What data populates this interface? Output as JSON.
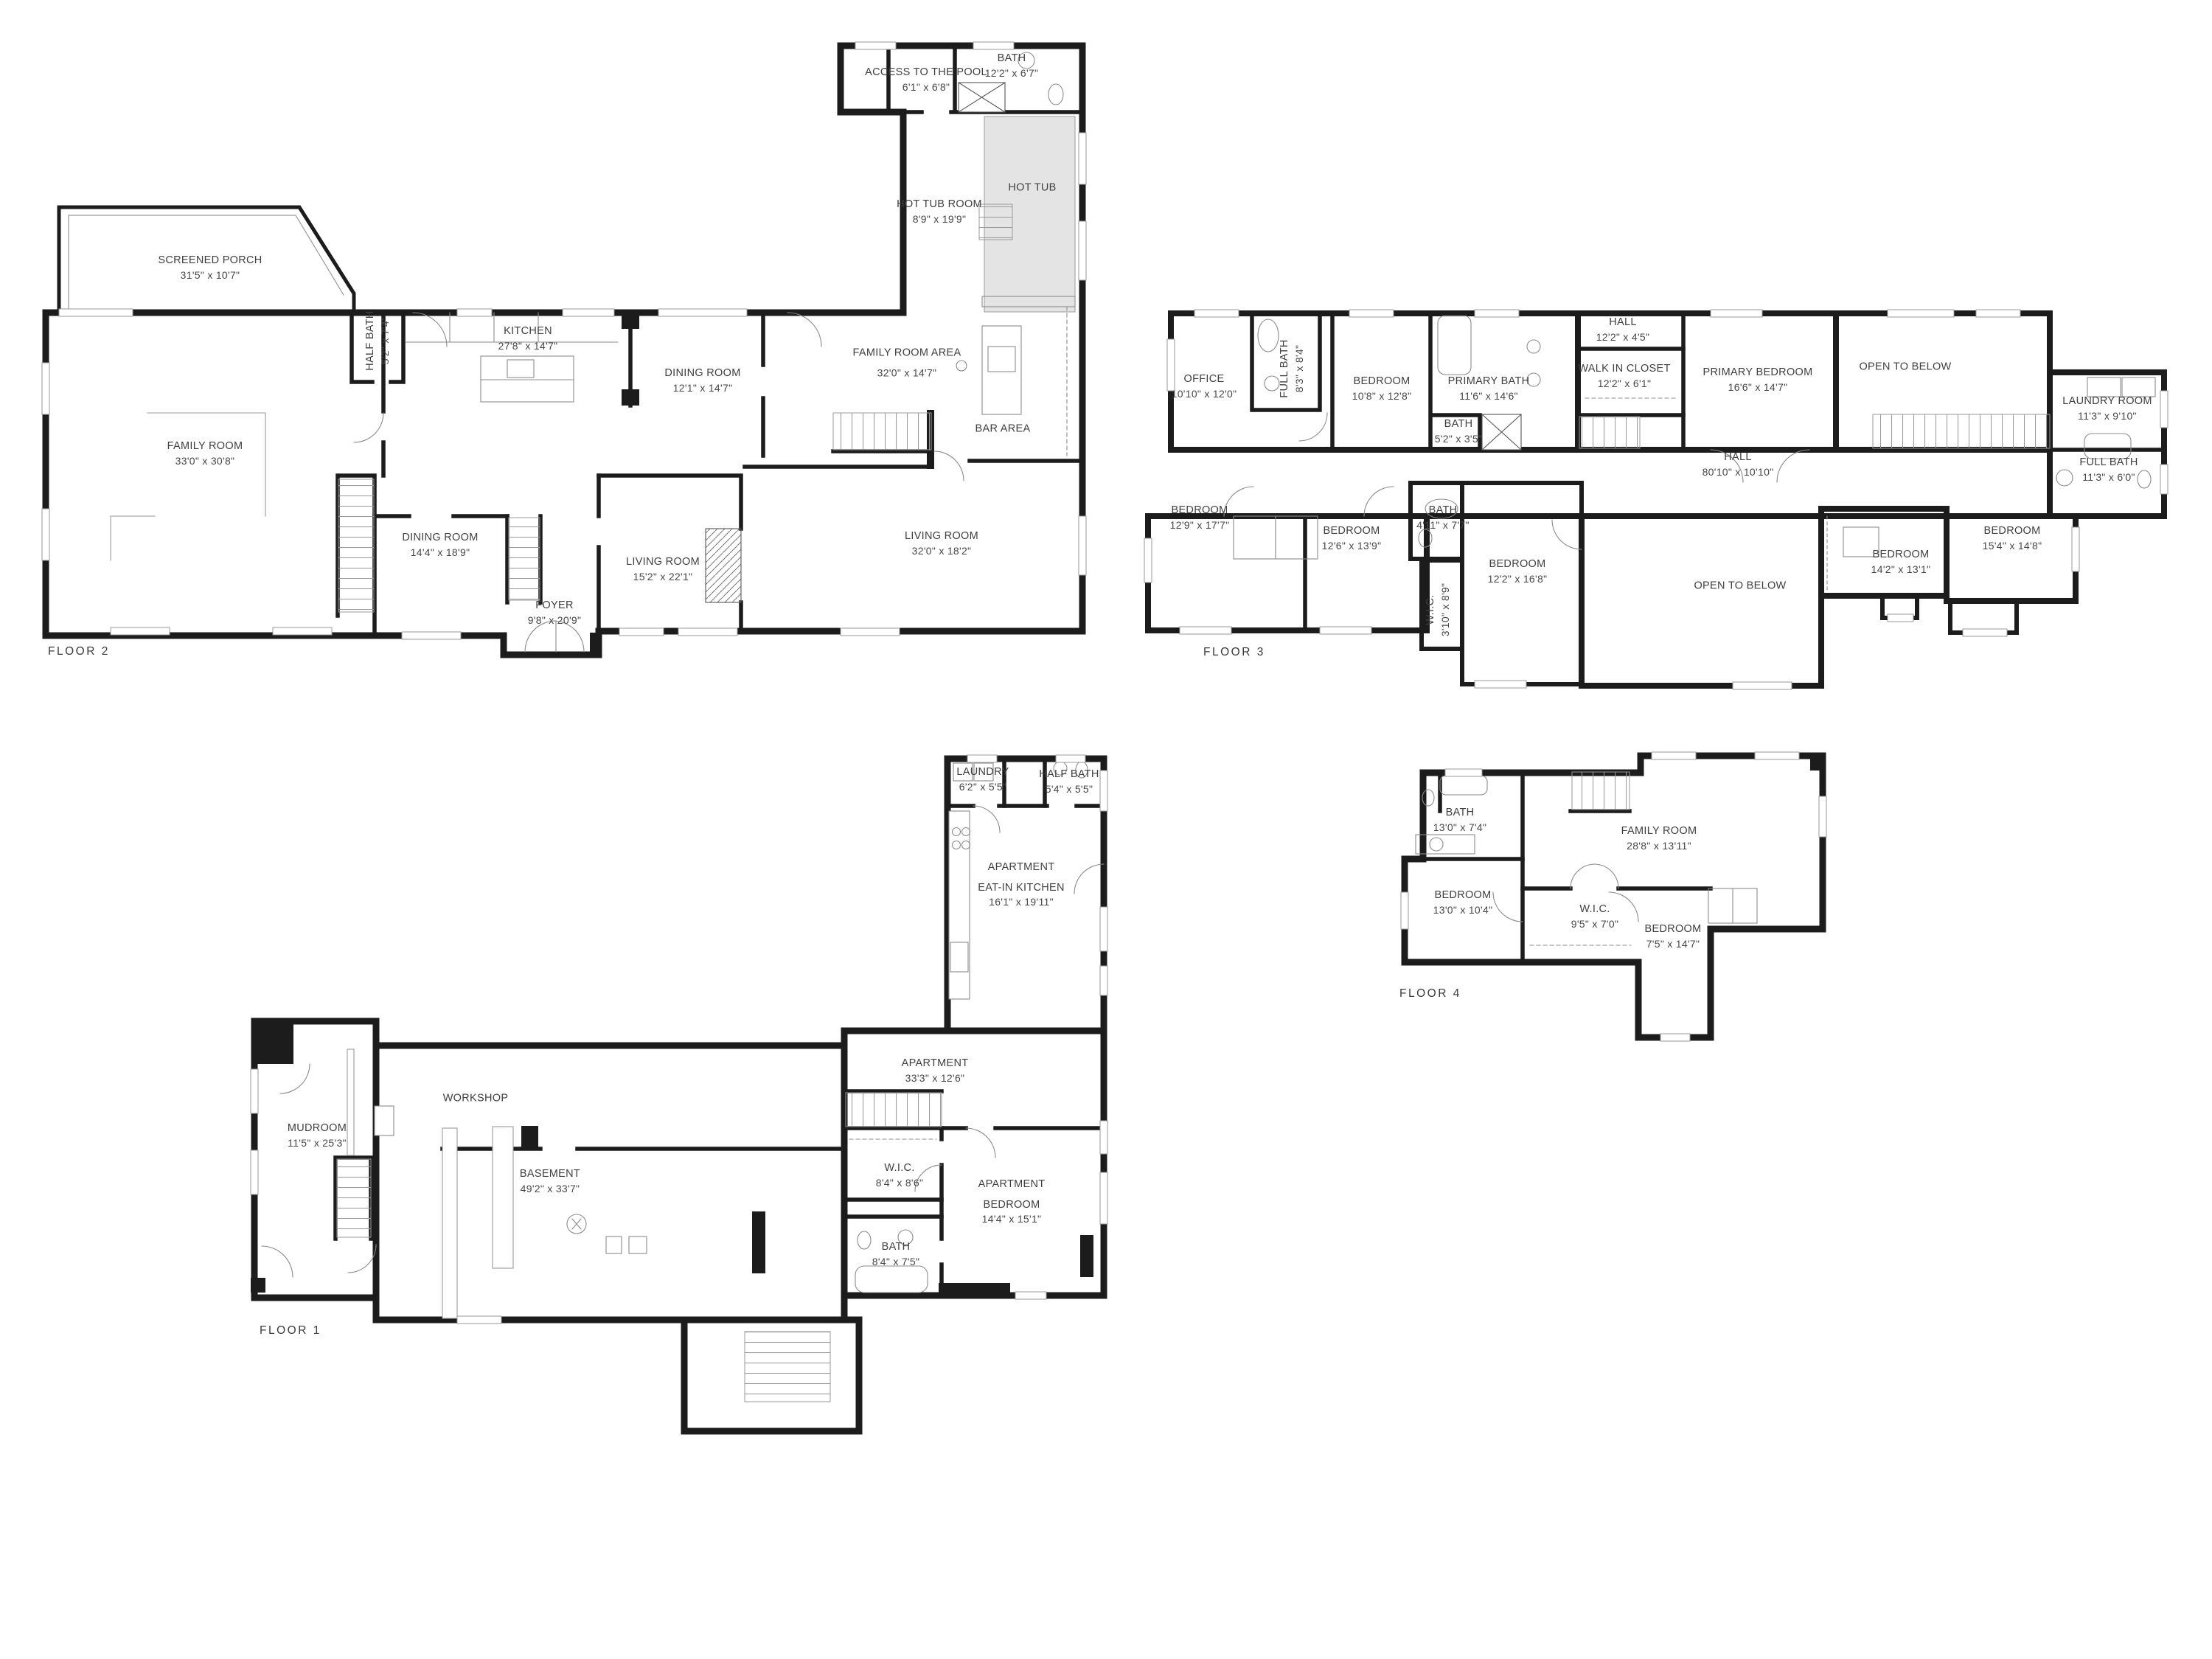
{
  "document": {
    "type": "multi-floor residential floor plan",
    "background": "#ffffff"
  },
  "colors": {
    "wall": "#1c1c1c",
    "thin_line": "#909090",
    "text": "#3f3f3f",
    "hot_tub_fill": "#e4e4e4"
  },
  "floors": [
    {
      "id": "floor-2",
      "title": "FLOOR 2",
      "rooms": [
        {
          "name": "SCREENED PORCH",
          "dims": "31'5\" x 10'7\""
        },
        {
          "name": "FAMILY ROOM",
          "dims": "33'0\" x 30'8\""
        },
        {
          "name": "HALF BATH",
          "dims": "5'2\" x 7'4\""
        },
        {
          "name": "KITCHEN",
          "dims": "27'8\" x 14'7\""
        },
        {
          "name": "DINING ROOM",
          "dims": "12'1\" x 14'7\""
        },
        {
          "name": "ACCESS TO THE POOL",
          "dims": "6'1\" x 6'8\""
        },
        {
          "name": "BATH",
          "dims": "12'2\" x 6'7\""
        },
        {
          "name": "HOT TUB ROOM",
          "dims": "8'9\" x 19'9\""
        },
        {
          "name": "HOT TUB",
          "dims": ""
        },
        {
          "name": "FAMILY ROOM AREA",
          "dims": "32'0\" x 14'7\""
        },
        {
          "name": "BAR AREA",
          "dims": ""
        },
        {
          "name": "DINING ROOM",
          "dims": "14'4\" x 18'9\""
        },
        {
          "name": "LIVING ROOM",
          "dims": "15'2\" x 22'1\""
        },
        {
          "name": "FOYER",
          "dims": "9'8\" x 20'9\""
        },
        {
          "name": "LIVING ROOM",
          "dims": "32'0\" x 18'2\""
        }
      ]
    },
    {
      "id": "floor-3",
      "title": "FLOOR 3",
      "rooms": [
        {
          "name": "OFFICE",
          "dims": "10'10\" x 12'0\""
        },
        {
          "name": "FULL BATH",
          "dims": "8'3\" x 8'4\""
        },
        {
          "name": "BEDROOM",
          "dims": "10'8\" x 12'8\""
        },
        {
          "name": "PRIMARY BATH",
          "dims": "11'6\" x 14'6\""
        },
        {
          "name": "BATH",
          "dims": "5'2\" x 3'5\""
        },
        {
          "name": "HALL",
          "dims": "12'2\" x 4'5\""
        },
        {
          "name": "WALK IN CLOSET",
          "dims": "12'2\" x 6'1\""
        },
        {
          "name": "PRIMARY BEDROOM",
          "dims": "16'6\" x 14'7\""
        },
        {
          "name": "OPEN TO BELOW",
          "dims": ""
        },
        {
          "name": "HALL",
          "dims": "80'10\" x 10'10\""
        },
        {
          "name": "LAUNDRY ROOM",
          "dims": "11'3\" x 9'10\""
        },
        {
          "name": "FULL BATH",
          "dims": "11'3\" x 6'0\""
        },
        {
          "name": "BEDROOM",
          "dims": "12'9\" x 17'7\""
        },
        {
          "name": "BEDROOM",
          "dims": "12'6\" x 13'9\""
        },
        {
          "name": "BATH",
          "dims": "4'11\" x 7'7\""
        },
        {
          "name": "W.I.C.",
          "dims": "3'10\" x 8'9\""
        },
        {
          "name": "BEDROOM",
          "dims": "12'2\" x 16'8\""
        },
        {
          "name": "OPEN TO BELOW",
          "dims": ""
        },
        {
          "name": "BEDROOM",
          "dims": "14'2\" x 13'1\""
        },
        {
          "name": "BEDROOM",
          "dims": "15'4\" x 14'8\""
        }
      ]
    },
    {
      "id": "floor-1",
      "title": "FLOOR 1",
      "rooms": [
        {
          "name": "LAUNDRY",
          "dims": "6'2\" x 5'5\""
        },
        {
          "name": "HALF BATH",
          "dims": "5'4\" x 5'5\""
        },
        {
          "prefix": "APARTMENT",
          "name": "EAT-IN KITCHEN",
          "dims": "16'1\" x 19'11\""
        },
        {
          "name": "APARTMENT",
          "dims": "33'3\" x 12'6\""
        },
        {
          "name": "MUDROOM",
          "dims": "11'5\" x 25'3\""
        },
        {
          "name": "WORKSHOP",
          "dims": ""
        },
        {
          "name": "BASEMENT",
          "dims": "49'2\" x 33'7\""
        },
        {
          "name": "W.I.C.",
          "dims": "8'4\" x 8'6\""
        },
        {
          "prefix": "APARTMENT",
          "name": "BEDROOM",
          "dims": "14'4\" x 15'1\""
        },
        {
          "name": "BATH",
          "dims": "8'4\" x 7'5\""
        }
      ]
    },
    {
      "id": "floor-4",
      "title": "FLOOR 4",
      "rooms": [
        {
          "name": "BATH",
          "dims": "13'0\" x 7'4\""
        },
        {
          "name": "FAMILY ROOM",
          "dims": "28'8\" x 13'11\""
        },
        {
          "name": "BEDROOM",
          "dims": "13'0\" x 10'4\""
        },
        {
          "name": "W.I.C.",
          "dims": "9'5\" x 7'0\""
        },
        {
          "name": "BEDROOM",
          "dims": "7'5\" x 14'7\""
        }
      ]
    }
  ]
}
